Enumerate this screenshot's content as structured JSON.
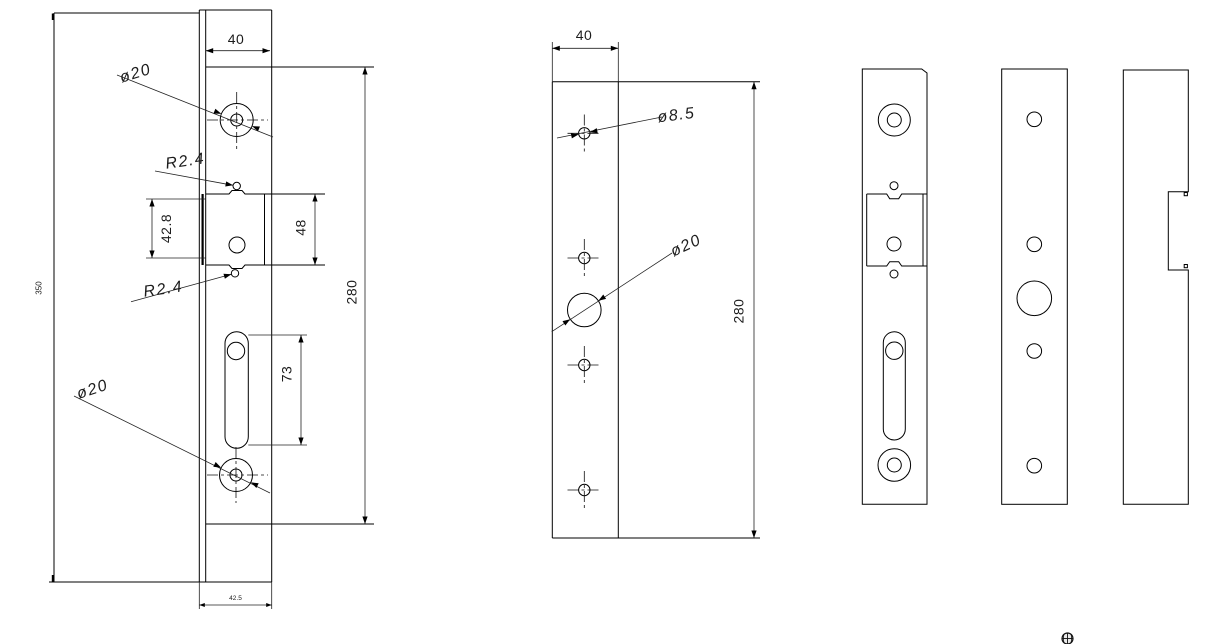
{
  "drawing": {
    "background": "#ffffff",
    "line_color": "#000000",
    "text_color": "#1c1c1c",
    "views": {
      "assembly_front": {
        "dims": {
          "faceplate_width": "40",
          "faceplate_length": "280",
          "overall_length": "350",
          "strip_width": "42.5",
          "latch_cutout_inner": "42.8",
          "latch_cutout_outer": "48",
          "slot_length": "73"
        },
        "callouts": {
          "top_hole": "ø20",
          "bottom_hole": "ø20",
          "top_notch_radius": "R2.4",
          "bottom_notch_radius": "R2.4"
        }
      },
      "keep_plate": {
        "dims": {
          "width": "40",
          "length": "280"
        },
        "callouts": {
          "screw_hole": "ø8.5",
          "large_hole": "ø20"
        }
      }
    }
  }
}
